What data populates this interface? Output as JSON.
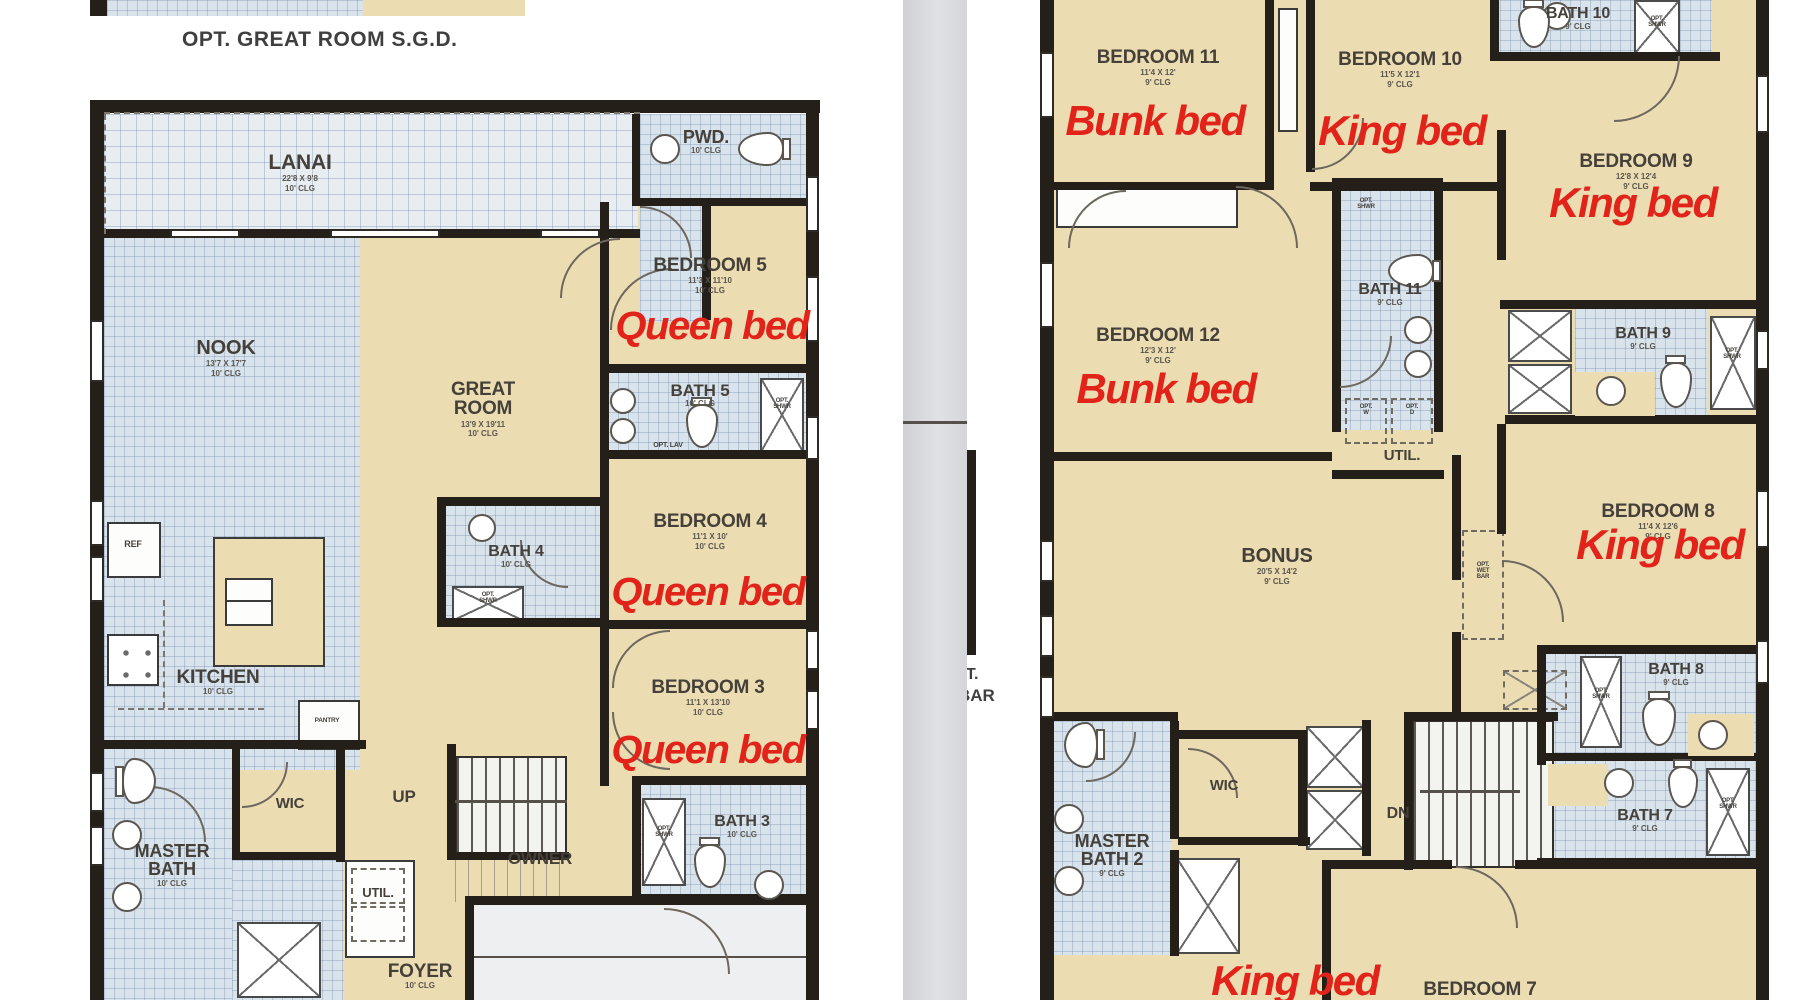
{
  "note": "OPT. GREAT ROOM S.G.D.",
  "between_fragments": {
    "top": "T.",
    "bottom": "BAR"
  },
  "colors": {
    "annotation_red": "#e2231a",
    "wall": "#241f19",
    "floor_beige": "#ecdcb2",
    "floor_tile": "#d9e3ec",
    "divider_gray": "#d5d7db"
  },
  "floor1": {
    "labels": [
      {
        "id": "lanai",
        "text": "LANAI",
        "dims": "22'8 X 9'8",
        "clg": "10' CLG",
        "x": 300,
        "y": 152,
        "size": 21
      },
      {
        "id": "pwd",
        "text": "PWD.",
        "clg": "10' CLG",
        "x": 706,
        "y": 128,
        "size": 18
      },
      {
        "id": "bedroom-5",
        "text": "BEDROOM 5",
        "dims": "11'3 X 11'10",
        "clg": "10' CLG",
        "x": 710,
        "y": 256,
        "size": 19
      },
      {
        "id": "nook",
        "text": "NOOK",
        "dims": "13'7 X 17'7",
        "clg": "10' CLG",
        "x": 226,
        "y": 338,
        "size": 20
      },
      {
        "id": "great-room",
        "text": "GREAT\nROOM",
        "dims": "13'9 X 19'11",
        "clg": "10' CLG",
        "x": 483,
        "y": 380,
        "size": 19
      },
      {
        "id": "bath-5",
        "text": "BATH 5",
        "clg": "10' CLG",
        "x": 700,
        "y": 382,
        "size": 17
      },
      {
        "id": "opt-lav",
        "text": "OPT. LAV",
        "x": 668,
        "y": 442,
        "size": 7
      },
      {
        "id": "opt-shwr-bath5",
        "text": "OPT.\nSHWR",
        "x": 782,
        "y": 398,
        "size": 6
      },
      {
        "id": "bedroom-4",
        "text": "BEDROOM 4",
        "dims": "11'1 X 10'",
        "clg": "10' CLG",
        "x": 710,
        "y": 512,
        "size": 19
      },
      {
        "id": "bath-4",
        "text": "BATH 4",
        "clg": "10' CLG",
        "x": 516,
        "y": 544,
        "size": 16
      },
      {
        "id": "opt-shwr-bath4",
        "text": "OPT.\nSHWR",
        "x": 488,
        "y": 592,
        "size": 6
      },
      {
        "id": "kitchen",
        "text": "KITCHEN",
        "clg": "10' CLG",
        "x": 218,
        "y": 668,
        "size": 19
      },
      {
        "id": "ref",
        "text": "REF",
        "x": 133,
        "y": 540,
        "size": 9
      },
      {
        "id": "pantry",
        "text": "PANTRY",
        "x": 327,
        "y": 718,
        "size": 6.5
      },
      {
        "id": "bedroom-3",
        "text": "BEDROOM 3",
        "dims": "11'1 X 13'10",
        "clg": "10' CLG",
        "x": 708,
        "y": 678,
        "size": 19
      },
      {
        "id": "wic",
        "text": "WIC",
        "x": 290,
        "y": 796,
        "size": 15
      },
      {
        "id": "up",
        "text": "UP",
        "x": 404,
        "y": 788,
        "size": 17
      },
      {
        "id": "owner",
        "text": "OWNER",
        "x": 540,
        "y": 850,
        "size": 17
      },
      {
        "id": "bath-3",
        "text": "BATH 3",
        "clg": "10' CLG",
        "x": 742,
        "y": 814,
        "size": 16
      },
      {
        "id": "opt-shwr-bath3",
        "text": "OPT.\nSHWR",
        "x": 664,
        "y": 826,
        "size": 6
      },
      {
        "id": "master-bath",
        "text": "MASTER\nBATH",
        "clg": "10' CLG",
        "x": 172,
        "y": 842,
        "size": 18
      },
      {
        "id": "util",
        "text": "UTIL.",
        "x": 378,
        "y": 886,
        "size": 13
      },
      {
        "id": "foyer",
        "text": "FOYER",
        "clg": "10' CLG",
        "x": 420,
        "y": 962,
        "size": 19
      }
    ],
    "annotations": [
      {
        "id": "bed5-queen",
        "text": "Queen bed",
        "x": 712,
        "y": 306,
        "size": 40
      },
      {
        "id": "bed4-queen",
        "text": "Queen bed",
        "x": 708,
        "y": 572,
        "size": 40
      },
      {
        "id": "bed3-queen",
        "text": "Queen bed",
        "x": 708,
        "y": 730,
        "size": 40
      }
    ]
  },
  "floor2": {
    "labels": [
      {
        "id": "bedroom-11",
        "text": "BEDROOM 11",
        "dims": "11'4 X 12'",
        "clg": "9' CLG",
        "x": 1158,
        "y": 48,
        "size": 19
      },
      {
        "id": "bedroom-10",
        "text": "BEDROOM 10",
        "dims": "11'5 X 12'1",
        "clg": "9' CLG",
        "x": 1400,
        "y": 50,
        "size": 19
      },
      {
        "id": "bath-10",
        "text": "BATH 10",
        "clg": "9' CLG",
        "x": 1578,
        "y": 6,
        "size": 16
      },
      {
        "id": "opt-shwr-bath10",
        "text": "OPT.\nSHWR",
        "x": 1657,
        "y": 16,
        "size": 6
      },
      {
        "id": "bedroom-9",
        "text": "BEDROOM 9",
        "dims": "12'8 X 12'4",
        "clg": "9' CLG",
        "x": 1636,
        "y": 152,
        "size": 19
      },
      {
        "id": "bath-11",
        "text": "BATH 11",
        "clg": "9' CLG",
        "x": 1390,
        "y": 282,
        "size": 16
      },
      {
        "id": "opt-shwr-bath11",
        "text": "OPT.\nSHWR",
        "x": 1366,
        "y": 198,
        "size": 6
      },
      {
        "id": "bedroom-12",
        "text": "BEDROOM 12",
        "dims": "12'3 X 12'",
        "clg": "9' CLG",
        "x": 1158,
        "y": 326,
        "size": 19
      },
      {
        "id": "bath-9",
        "text": "BATH 9",
        "clg": "9' CLG",
        "x": 1643,
        "y": 326,
        "size": 16
      },
      {
        "id": "opt-shwr-bath9",
        "text": "OPT.\nSHWR",
        "x": 1732,
        "y": 348,
        "size": 6
      },
      {
        "id": "util-2",
        "text": "UTIL.",
        "x": 1402,
        "y": 448,
        "size": 15
      },
      {
        "id": "opt-w",
        "text": "OPT.\nW",
        "x": 1366,
        "y": 404,
        "size": 6
      },
      {
        "id": "opt-d",
        "text": "OPT.\nD",
        "x": 1412,
        "y": 404,
        "size": 6
      },
      {
        "id": "bonus",
        "text": "BONUS",
        "dims": "20'5 X 14'2",
        "clg": "9' CLG",
        "x": 1277,
        "y": 546,
        "size": 20
      },
      {
        "id": "opt-wet-bar",
        "text": "OPT.\nWET\nBAR",
        "x": 1483,
        "y": 562,
        "size": 6
      },
      {
        "id": "bedroom-8",
        "text": "BEDROOM 8",
        "dims": "11'4 X 12'6",
        "clg": "9' CLG",
        "x": 1658,
        "y": 502,
        "size": 19
      },
      {
        "id": "bath-8",
        "text": "BATH 8",
        "clg": "9' CLG",
        "x": 1676,
        "y": 662,
        "size": 16
      },
      {
        "id": "opt-shwr-bath8",
        "text": "OPT.\nSHWR",
        "x": 1601,
        "y": 688,
        "size": 6
      },
      {
        "id": "dn",
        "text": "DN",
        "x": 1398,
        "y": 806,
        "size": 16
      },
      {
        "id": "bath-7",
        "text": "BATH 7",
        "clg": "9' CLG",
        "x": 1645,
        "y": 808,
        "size": 16
      },
      {
        "id": "opt-shwr-bath7",
        "text": "OPT.\nSHWR",
        "x": 1728,
        "y": 798,
        "size": 6
      },
      {
        "id": "master-bath-2",
        "text": "MASTER\nBATH 2",
        "clg": "9' CLG",
        "x": 1112,
        "y": 832,
        "size": 18
      },
      {
        "id": "wic-2",
        "text": "WIC",
        "x": 1224,
        "y": 778,
        "size": 15
      },
      {
        "id": "bedroom-7",
        "text": "BEDROOM 7",
        "x": 1480,
        "y": 980,
        "size": 19
      }
    ],
    "annotations": [
      {
        "id": "bed11-bunk",
        "text": "Bunk bed",
        "x": 1155,
        "y": 100,
        "size": 42
      },
      {
        "id": "bed10-king",
        "text": "King bed",
        "x": 1402,
        "y": 110,
        "size": 42
      },
      {
        "id": "bed9-king",
        "text": "King bed",
        "x": 1633,
        "y": 182,
        "size": 42
      },
      {
        "id": "bed12-bunk",
        "text": "Bunk bed",
        "x": 1166,
        "y": 368,
        "size": 42
      },
      {
        "id": "bed8-king",
        "text": "King bed",
        "x": 1660,
        "y": 524,
        "size": 42
      },
      {
        "id": "master2-king",
        "text": "King bed",
        "x": 1295,
        "y": 960,
        "size": 42
      }
    ]
  }
}
